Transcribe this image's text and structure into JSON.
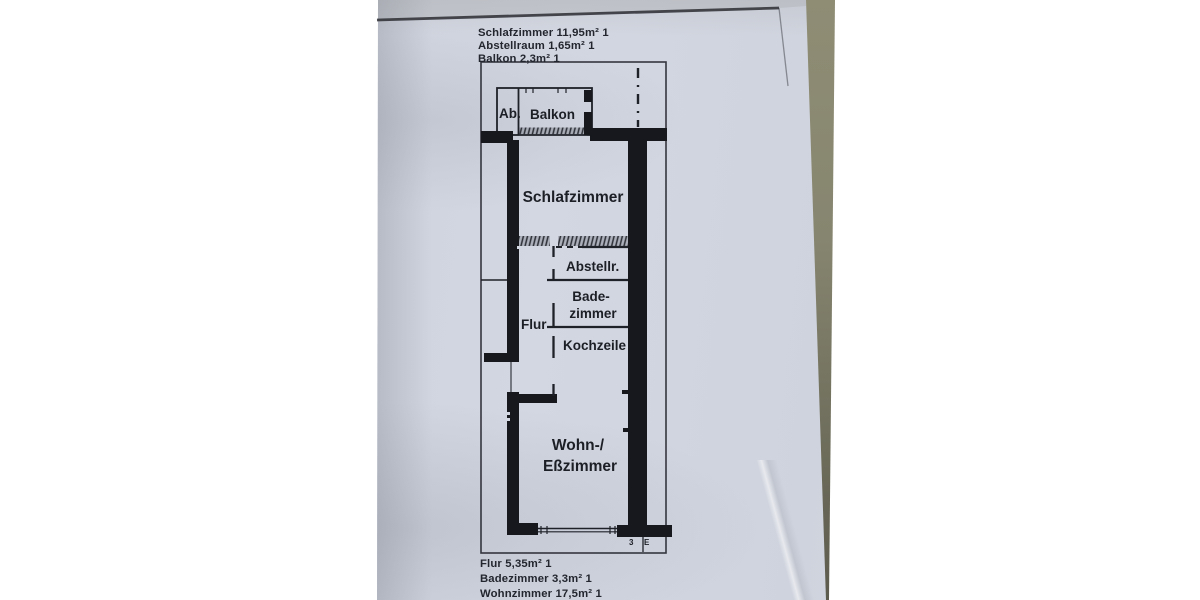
{
  "document_type": "apartment floor plan photocopy (photo)",
  "annotations": {
    "top": [
      "Schlafzimmer 11,95m² 1",
      "Abstellraum 1,65m² 1",
      "Balkon 2,3m² 1"
    ],
    "bottom": [
      "Flur 5,35m² 1",
      "Badezimmer 3,3m² 1",
      "Wohnzimmer 17,5m² 1"
    ]
  },
  "rooms": {
    "ab": "Ab.",
    "balkon": "Balkon",
    "schlafzimmer": "Schlafzimmer",
    "abstellraum": "Abstellr.",
    "bad_line1": "Bade-",
    "bad_line2": "zimmer",
    "flur": "Flur",
    "kochzeile": "Kochzeile",
    "wohnzimmer_line1": "Wohn-/",
    "wohnzimmer_line2": "Eßzimmer"
  },
  "plan_marks": {
    "mark_3": "3",
    "mark_e": "E"
  },
  "colors": {
    "background": "#ffffff",
    "paper": "#d0d4de",
    "ink": "#1f2128",
    "table_strip": "#8f8d74"
  }
}
